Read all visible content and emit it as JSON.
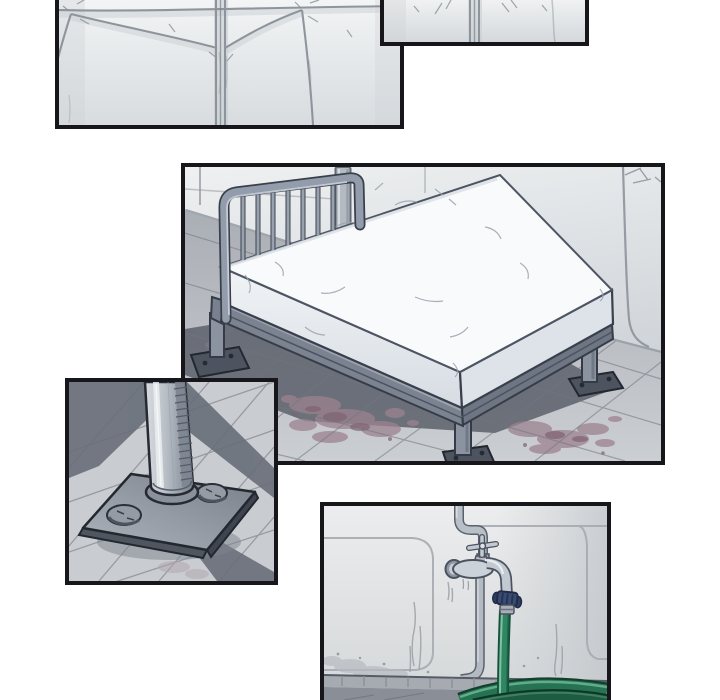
{
  "page": {
    "kind": "webtoon-comic-page",
    "background": "#ffffff",
    "panel_count": "5"
  },
  "colors": {
    "border": "#17171b",
    "tile_light": "#f1f3f4",
    "tile_shade": "#d7dbde",
    "grout": "#8a9199",
    "wall_light": "#eef0f1",
    "wall_shade": "#c9ced3",
    "floor_light": "#c4c7cc",
    "floor_shadow": "#5e636d",
    "metal_light": "#dde2e8",
    "metal_mid": "#99a2af",
    "metal_dark": "#3a414d",
    "mattress_white": "#f9fafb",
    "mattress_shade": "#e0e5eb",
    "stain_mauve": "#9c8290",
    "stain_dark": "#7f6273",
    "hose_green": "#2f8663",
    "hose_green_dark": "#1d5c41",
    "hose_highlight": "#8cc7a8",
    "clamp_navy": "#3c4c70",
    "pipe_gray": "#b9bfc7"
  },
  "panels": {
    "wall_left": {
      "name": "wall-tiles-wide",
      "description": "Wide panel of large pale wall tiles with dark grout seams, cropped by the top edge of the page"
    },
    "wall_right": {
      "name": "wall-tiles-sliver",
      "description": "Small sliver panel of the same tiled wall, cropped by the top edge of the page"
    },
    "bed_room": {
      "name": "bed-room",
      "description": "Steel frame bed with a bare white mattress in a tiled room, legs bolted to the floor, dark shadow and dried stains beneath"
    },
    "leg_closeup": {
      "name": "bolted-leg-closeup",
      "description": "Close-up of a cylindrical bed leg welded to a base plate bolted into the tiled floor"
    },
    "faucet": {
      "name": "faucet-hose",
      "description": "Wall faucet with a cross handle and a green hose attached, coiling on the floor below"
    }
  }
}
